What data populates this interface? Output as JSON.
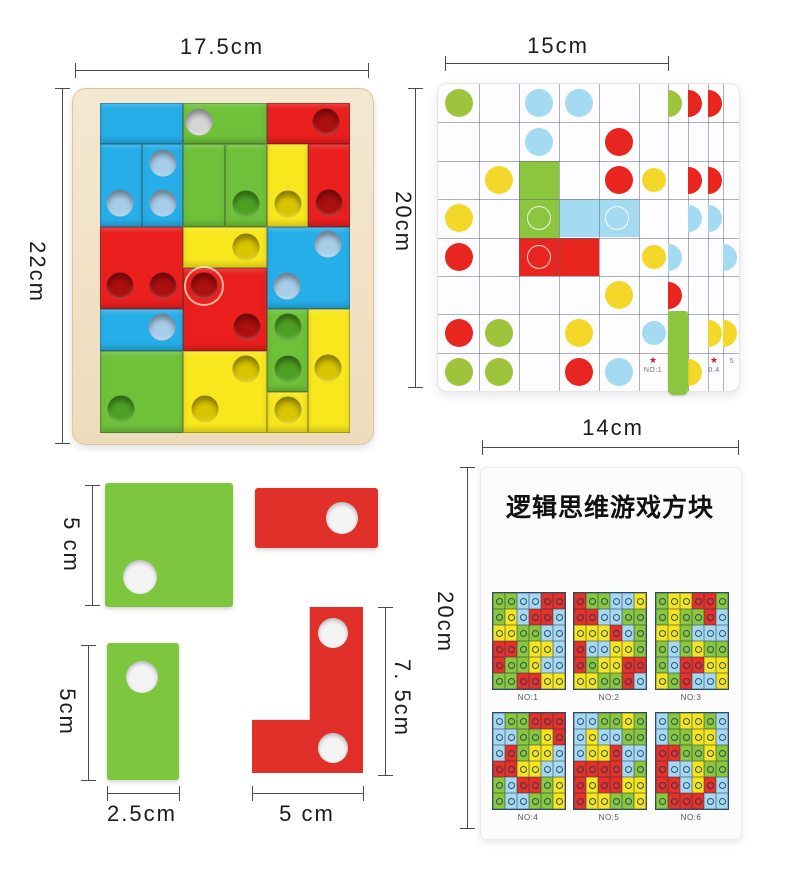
{
  "colors": {
    "blue": "#26aee9",
    "green": "#6fc13a",
    "red": "#ea1f1e",
    "yellow": "#f8e71d",
    "dotBlue": "#a8cde9",
    "dotGreen": "#4da023",
    "dotRed": "#ab0f0e",
    "dotYellow": "#d9c400",
    "dotGray": "#d5d5d5",
    "gbGreen": "#9ec43b",
    "gbRed": "#e8251f",
    "gbYellow": "#f3d829",
    "gbBlue": "#a5dbf2",
    "gbBarGreen": "#8cc63e",
    "looseGreen": "#7dc63e",
    "looseRed": "#e03029"
  },
  "dims": {
    "puzzle_w": "17.5cm",
    "puzzle_h": "22cm",
    "game_w": "15cm",
    "game_h": "20cm",
    "booklet_w": "14cm",
    "booklet_h": "20cm",
    "square_h": "5 cm",
    "vert_h": "5cm",
    "vert_w": "2.5cm",
    "l_h": "7. 5cm",
    "l_w": "5 cm"
  },
  "puzzle_board": {
    "pieces": [
      {
        "c": 0,
        "r": 0,
        "w": 2,
        "h": 1,
        "color": "blue",
        "dots": []
      },
      {
        "c": 0,
        "r": 1,
        "w": 1,
        "h": 2,
        "color": "blue",
        "dots": [
          {
            "x": 0.48,
            "y": 2.42,
            "color": "dotBlue"
          }
        ]
      },
      {
        "c": 1,
        "r": 1,
        "w": 1,
        "h": 2,
        "color": "blue",
        "dots": [
          {
            "x": 1.5,
            "y": 1.45,
            "color": "dotBlue"
          },
          {
            "x": 1.5,
            "y": 2.42,
            "color": "dotBlue"
          }
        ]
      },
      {
        "c": 2,
        "r": 0,
        "w": 2,
        "h": 1,
        "color": "green",
        "dots": [
          {
            "x": 2.38,
            "y": 0.45,
            "color": "dotGray"
          }
        ]
      },
      {
        "c": 2,
        "r": 1,
        "w": 1,
        "h": 2,
        "color": "green",
        "dots": []
      },
      {
        "c": 3,
        "r": 1,
        "w": 1,
        "h": 2,
        "color": "green",
        "dots": [
          {
            "x": 3.5,
            "y": 2.45,
            "color": "dotGreen"
          }
        ]
      },
      {
        "c": 4,
        "r": 1,
        "w": 1,
        "h": 2,
        "color": "yellow",
        "dots": [
          {
            "x": 4.5,
            "y": 2.45,
            "color": "dotYellow"
          }
        ]
      },
      {
        "c": 4,
        "r": 0,
        "w": 2,
        "h": 1,
        "color": "red",
        "dots": [
          {
            "x": 5.42,
            "y": 0.45,
            "color": "dotRed"
          }
        ]
      },
      {
        "c": 5,
        "r": 1,
        "w": 1,
        "h": 2,
        "color": "red",
        "dots": [
          {
            "x": 5.5,
            "y": 2.42,
            "color": "dotRed"
          }
        ]
      },
      {
        "c": 0,
        "r": 3,
        "w": 2,
        "h": 2,
        "color": "red",
        "dots": [
          {
            "x": 0.48,
            "y": 4.44,
            "color": "dotRed"
          },
          {
            "x": 1.5,
            "y": 4.44,
            "color": "dotRed"
          }
        ]
      },
      {
        "c": 2,
        "r": 3,
        "w": 2,
        "h": 1,
        "color": "yellow",
        "dots": [
          {
            "x": 3.5,
            "y": 3.5,
            "color": "dotYellow"
          }
        ]
      },
      {
        "c": 2,
        "r": 4,
        "w": 2,
        "h": 2,
        "color": "red",
        "dots": [
          {
            "x": 2.5,
            "y": 4.44,
            "color": "dotRed",
            "ring": true
          },
          {
            "x": 3.52,
            "y": 5.44,
            "color": "dotRed"
          }
        ]
      },
      {
        "c": 4,
        "r": 3,
        "w": 2,
        "h": 2,
        "color": "blue",
        "dots": [
          {
            "x": 5.48,
            "y": 3.43,
            "color": "dotBlue"
          },
          {
            "x": 4.48,
            "y": 4.44,
            "color": "dotBlue"
          }
        ]
      },
      {
        "c": 0,
        "r": 5,
        "w": 2,
        "h": 1,
        "color": "blue",
        "dots": [
          {
            "x": 1.48,
            "y": 5.44,
            "color": "dotBlue"
          }
        ]
      },
      {
        "c": 0,
        "r": 6,
        "w": 2,
        "h": 2,
        "color": "green",
        "dots": [
          {
            "x": 0.5,
            "y": 7.42,
            "color": "dotGreen"
          }
        ]
      },
      {
        "c": 2,
        "r": 6,
        "w": 2,
        "h": 2,
        "color": "yellow",
        "dots": [
          {
            "x": 3.5,
            "y": 6.45,
            "color": "dotYellow"
          },
          {
            "x": 2.52,
            "y": 7.42,
            "color": "dotYellow"
          }
        ]
      },
      {
        "c": 4,
        "r": 5,
        "w": 1,
        "h": 2,
        "color": "green",
        "dots": [
          {
            "x": 4.5,
            "y": 5.44,
            "color": "dotGreen"
          },
          {
            "x": 4.5,
            "y": 6.45,
            "color": "dotGreen"
          }
        ]
      },
      {
        "c": 5,
        "r": 5,
        "w": 1,
        "h": 3,
        "color": "yellow",
        "dots": [
          {
            "x": 5.47,
            "y": 6.42,
            "color": "dotYellow"
          }
        ]
      },
      {
        "c": 4,
        "r": 7,
        "w": 1,
        "h": 1,
        "color": "yellow",
        "dots": [
          {
            "x": 4.5,
            "y": 7.44,
            "color": "dotYellow"
          }
        ]
      }
    ],
    "notches": [
      {
        "x": 352,
        "y": 120
      },
      {
        "x": 94,
        "y": 411
      }
    ]
  },
  "game_board": {
    "dots": [
      {
        "r": 0,
        "c": 0,
        "color": "gbGreen"
      },
      {
        "r": 0,
        "c": 2,
        "color": "gbBlue"
      },
      {
        "r": 0,
        "c": 3,
        "color": "gbBlue"
      },
      {
        "r": 1,
        "c": 2,
        "color": "gbBlue"
      },
      {
        "r": 1,
        "c": 4,
        "color": "gbRed"
      },
      {
        "r": 2,
        "c": 1,
        "color": "gbYellow"
      },
      {
        "r": 2,
        "c": 4,
        "color": "gbRed"
      },
      {
        "r": 2,
        "c": 5,
        "color": "gbYellow"
      },
      {
        "r": 3,
        "c": 0,
        "color": "gbYellow"
      },
      {
        "r": 4,
        "c": 0,
        "color": "gbRed"
      },
      {
        "r": 4,
        "c": 5,
        "color": "gbYellow"
      },
      {
        "r": 5,
        "c": 4,
        "color": "gbYellow"
      },
      {
        "r": 6,
        "c": 0,
        "color": "gbRed"
      },
      {
        "r": 6,
        "c": 1,
        "color": "gbGreen"
      },
      {
        "r": 6,
        "c": 3,
        "color": "gbYellow"
      },
      {
        "r": 6,
        "c": 5,
        "color": "gbBlue"
      },
      {
        "r": 7,
        "c": 0,
        "color": "gbGreen"
      },
      {
        "r": 7,
        "c": 1,
        "color": "gbGreen"
      },
      {
        "r": 7,
        "c": 3,
        "color": "gbRed"
      },
      {
        "r": 7,
        "c": 4,
        "color": "gbBlue"
      }
    ],
    "bg_cells": [
      {
        "x": 81,
        "y": 77,
        "w": 40,
        "h": 77,
        "color": "gbBarGreen",
        "rings": [
          {
            "x": 101,
            "y": 134
          }
        ]
      },
      {
        "x": 121,
        "y": 115,
        "w": 80,
        "h": 38,
        "color": "gbBlue",
        "rings": [
          {
            "x": 179,
            "y": 134
          }
        ]
      },
      {
        "x": 81,
        "y": 154,
        "w": 80,
        "h": 38,
        "color": "gbRed",
        "rings": [
          {
            "x": 101,
            "y": 173
          }
        ]
      }
    ],
    "edge_halves": [
      {
        "r": 0,
        "x": 230,
        "color": "gbGreen"
      },
      {
        "r": 0,
        "x": 250,
        "color": "gbRed"
      },
      {
        "r": 0,
        "x": 270,
        "color": "gbRed"
      },
      {
        "r": 2,
        "x": 250,
        "color": "gbRed"
      },
      {
        "r": 2,
        "x": 270,
        "color": "gbRed"
      },
      {
        "r": 3,
        "x": 250,
        "color": "gbBlue"
      },
      {
        "r": 3,
        "x": 270,
        "color": "gbBlue"
      },
      {
        "r": 4,
        "x": 230,
        "color": "gbBlue"
      },
      {
        "r": 4,
        "x": 285,
        "color": "gbBlue"
      },
      {
        "r": 5,
        "x": 230,
        "color": "gbRed"
      },
      {
        "r": 6,
        "x": 270,
        "color": "gbYellow"
      },
      {
        "r": 6,
        "x": 285,
        "color": "gbYellow"
      },
      {
        "r": 7,
        "x": 250,
        "color": "gbYellow"
      }
    ],
    "bar": {
      "x": 230,
      "y": 227,
      "w": 20,
      "h": 84
    },
    "tags": [
      {
        "x": 215,
        "y": 272,
        "star": "★",
        "text": "NO:1"
      },
      {
        "x": 276,
        "y": 272,
        "star": "★",
        "text": "0.4"
      },
      {
        "x": 294,
        "y": 272,
        "star": "",
        "text": "5"
      }
    ]
  },
  "booklet": {
    "title": "逻辑思维游戏方块",
    "cell_colors": {
      "g": "#8cc63c",
      "y": "#f6e41f",
      "r": "#e63028",
      "b": "#a8d8f0"
    },
    "puzzles": [
      {
        "label": "NO:1",
        "grid": [
          [
            "g",
            "g",
            "b",
            "b",
            "r",
            "r"
          ],
          [
            "g",
            "y",
            "b",
            "r",
            "r",
            "b"
          ],
          [
            "y",
            "y",
            "g",
            "g",
            "b",
            "b"
          ],
          [
            "r",
            "r",
            "g",
            "y",
            "y",
            "b"
          ],
          [
            "r",
            "g",
            "g",
            "y",
            "b",
            "b"
          ],
          [
            "g",
            "g",
            "r",
            "r",
            "y",
            "y"
          ]
        ]
      },
      {
        "label": "NO:2",
        "grid": [
          [
            "r",
            "g",
            "g",
            "b",
            "b",
            "y"
          ],
          [
            "r",
            "r",
            "b",
            "b",
            "g",
            "g"
          ],
          [
            "y",
            "y",
            "y",
            "r",
            "b",
            "g"
          ],
          [
            "r",
            "b",
            "b",
            "y",
            "y",
            "g"
          ],
          [
            "r",
            "g",
            "y",
            "y",
            "r",
            "r"
          ],
          [
            "y",
            "y",
            "g",
            "g",
            "r",
            "b"
          ]
        ]
      },
      {
        "label": "NO:3",
        "grid": [
          [
            "g",
            "y",
            "y",
            "r",
            "r",
            "g"
          ],
          [
            "g",
            "y",
            "g",
            "g",
            "r",
            "b"
          ],
          [
            "y",
            "y",
            "g",
            "b",
            "b",
            "b"
          ],
          [
            "g",
            "b",
            "g",
            "y",
            "g",
            "g"
          ],
          [
            "g",
            "b",
            "r",
            "r",
            "y",
            "y"
          ],
          [
            "y",
            "g",
            "r",
            "b",
            "b",
            "y"
          ]
        ]
      },
      {
        "label": "NO:4",
        "grid": [
          [
            "b",
            "g",
            "g",
            "r",
            "r",
            "r"
          ],
          [
            "b",
            "b",
            "g",
            "g",
            "y",
            "r"
          ],
          [
            "b",
            "r",
            "g",
            "y",
            "y",
            "b"
          ],
          [
            "r",
            "r",
            "y",
            "y",
            "b",
            "b"
          ],
          [
            "g",
            "b",
            "r",
            "r",
            "g",
            "y"
          ],
          [
            "g",
            "b",
            "b",
            "g",
            "g",
            "y"
          ]
        ]
      },
      {
        "label": "NO:5",
        "grid": [
          [
            "b",
            "b",
            "g",
            "g",
            "y",
            "g"
          ],
          [
            "b",
            "y",
            "b",
            "b",
            "g",
            "g"
          ],
          [
            "b",
            "y",
            "y",
            "r",
            "b",
            "b"
          ],
          [
            "r",
            "r",
            "r",
            "r",
            "b",
            "g"
          ],
          [
            "r",
            "y",
            "r",
            "r",
            "y",
            "y"
          ],
          [
            "r",
            "y",
            "y",
            "g",
            "g",
            "y"
          ]
        ]
      },
      {
        "label": "NO:6",
        "grid": [
          [
            "b",
            "g",
            "y",
            "y",
            "g",
            "b"
          ],
          [
            "b",
            "g",
            "g",
            "y",
            "y",
            "b"
          ],
          [
            "r",
            "r",
            "g",
            "g",
            "y",
            "g"
          ],
          [
            "r",
            "b",
            "b",
            "y",
            "g",
            "g"
          ],
          [
            "r",
            "r",
            "b",
            "y",
            "r",
            "b"
          ],
          [
            "g",
            "r",
            "r",
            "r",
            "b",
            "b"
          ]
        ]
      }
    ]
  }
}
